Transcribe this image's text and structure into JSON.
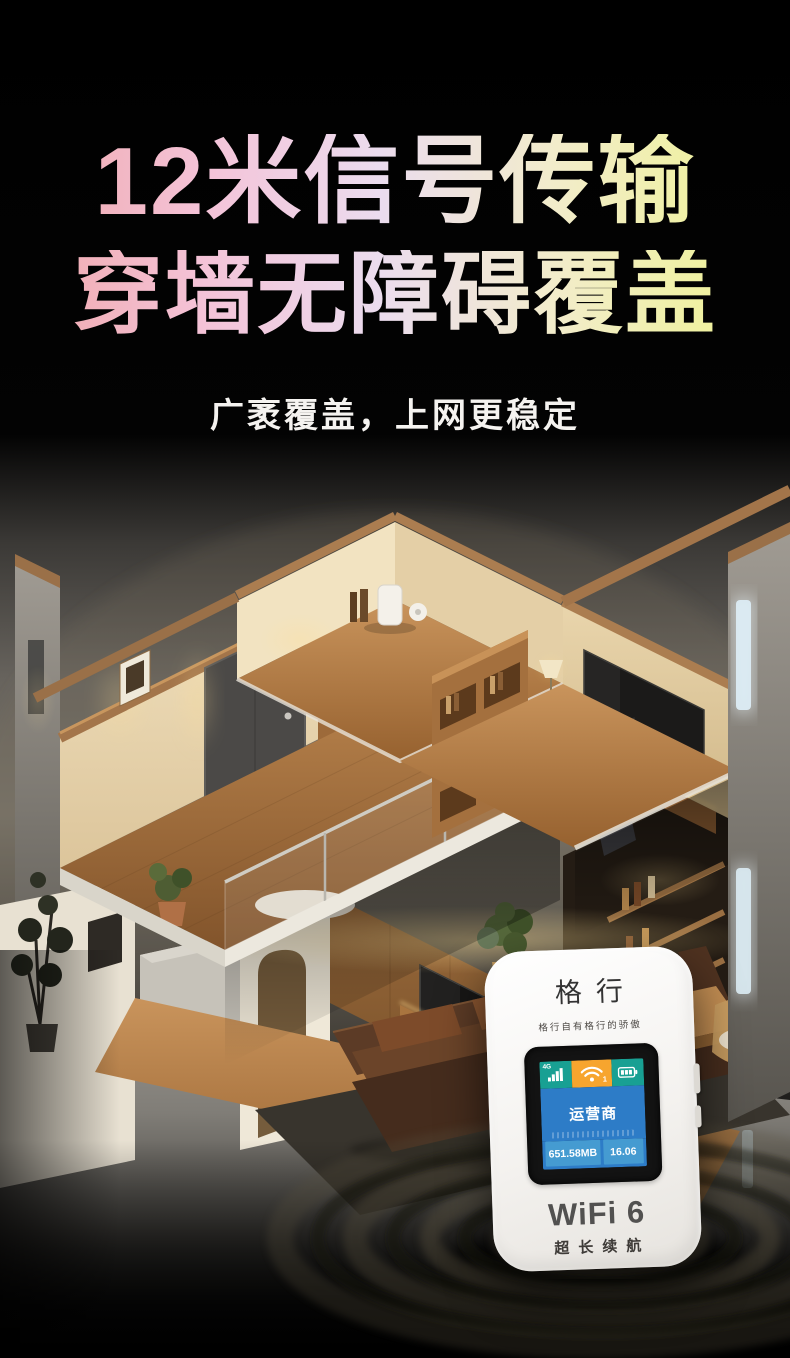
{
  "hero": {
    "title_line1": "12米信号传输",
    "title_line2": "穿墙无障碍覆盖",
    "subtitle": "广袤覆盖，上网更稳定",
    "title_gradient_start": "#f0a8ab",
    "title_gradient_mid": "#ebdcee",
    "title_gradient_end": "#eff394"
  },
  "device": {
    "brand": "格行",
    "slogan": "格行自有格行的骄傲",
    "model_label": "WiFi 6",
    "battery_label": "超长续航",
    "screen": {
      "network_badge": "4G",
      "wifi_badge": "1",
      "carrier": "运营商",
      "data_used": "651.58MB",
      "time": "16.06",
      "status_teal": "#18a093",
      "status_orange": "#f7a52e",
      "screen_blue": "#2d7cc7",
      "footer_blue": "#459bd1"
    }
  },
  "scene": {
    "illustration": "isometric-cutaway-apartment",
    "palette": {
      "wall_cream": "#f0e0bd",
      "wood_floor": "#c9945c",
      "wood_cap": "#a3754a",
      "ground_gray": "#9a9791",
      "window_glow": "#dcecf4",
      "warm_glow": "#ffe0a0",
      "sofa_brown": "#4a3021",
      "background_black": "#000000"
    }
  }
}
